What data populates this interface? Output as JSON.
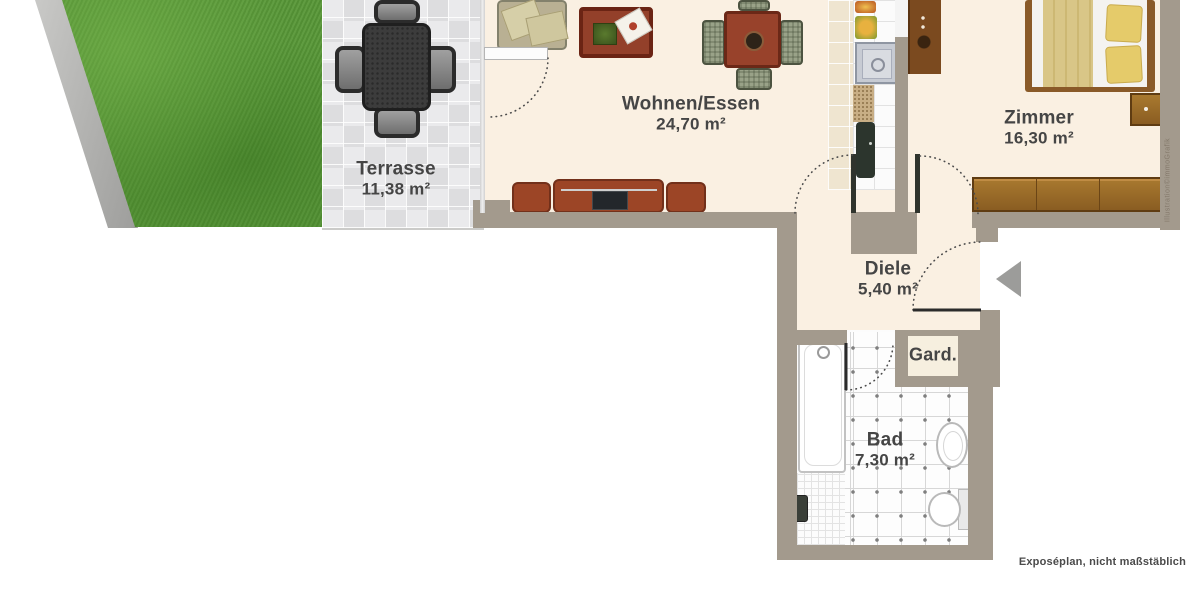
{
  "plan": {
    "footer_note": "Exposéplan, nicht maßstäblich",
    "watermark": "Illustration©immoGrafik"
  },
  "rooms": [
    {
      "name": "Terrasse",
      "area": "11,38 m²"
    },
    {
      "name": "Wohnen/Essen",
      "area": "24,70 m²"
    },
    {
      "name": "Zimmer",
      "area": "16,30 m²"
    },
    {
      "name": "Diele",
      "area": "5,40 m²"
    },
    {
      "name": "Gard.",
      "area": ""
    },
    {
      "name": "Bad",
      "area": "7,30 m²"
    }
  ],
  "colors": {
    "wall": "#a39a8d",
    "floor": "#faf0e2",
    "grass": "#579737",
    "terrace_tile": "#eaeaec",
    "wood": "#96662c",
    "sofa": "#9c4526",
    "label_text": "#454545",
    "arrow": "#9c9c9a"
  }
}
